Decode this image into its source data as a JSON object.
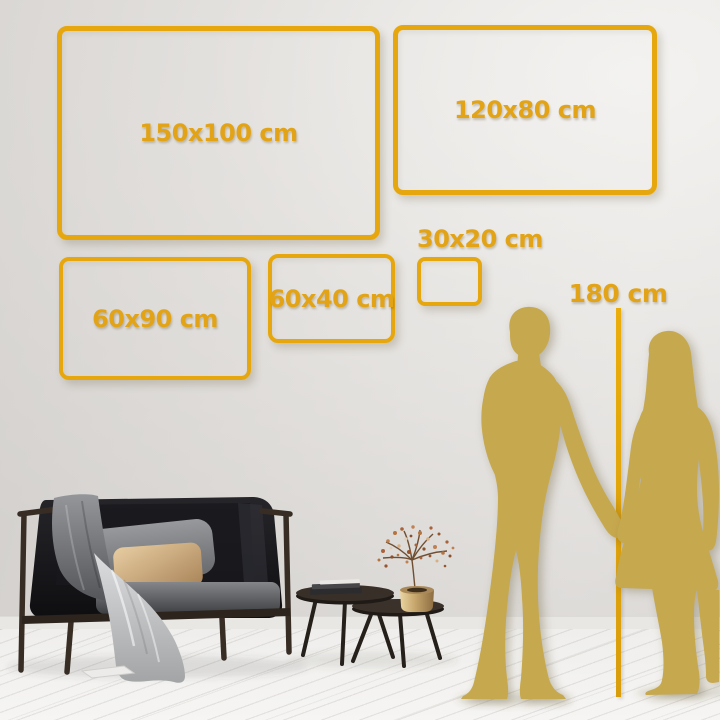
{
  "size_guide": {
    "frames": [
      {
        "id": "150x100",
        "label": "150x100 cm"
      },
      {
        "id": "120x80",
        "label": "120x80 cm"
      },
      {
        "id": "60x90",
        "label": "60x90 cm"
      },
      {
        "id": "60x40",
        "label": "60x40 cm"
      },
      {
        "id": "30x20",
        "label": "30x20 cm"
      }
    ],
    "height_marker": {
      "label": "180 cm"
    },
    "colors": {
      "accent_gold": "#E6A70E",
      "gold_text": "#E2A416",
      "silhouette_gold": "#C6A84E",
      "wall": "#E2DFDC",
      "floor": "#F2F1EF"
    }
  }
}
